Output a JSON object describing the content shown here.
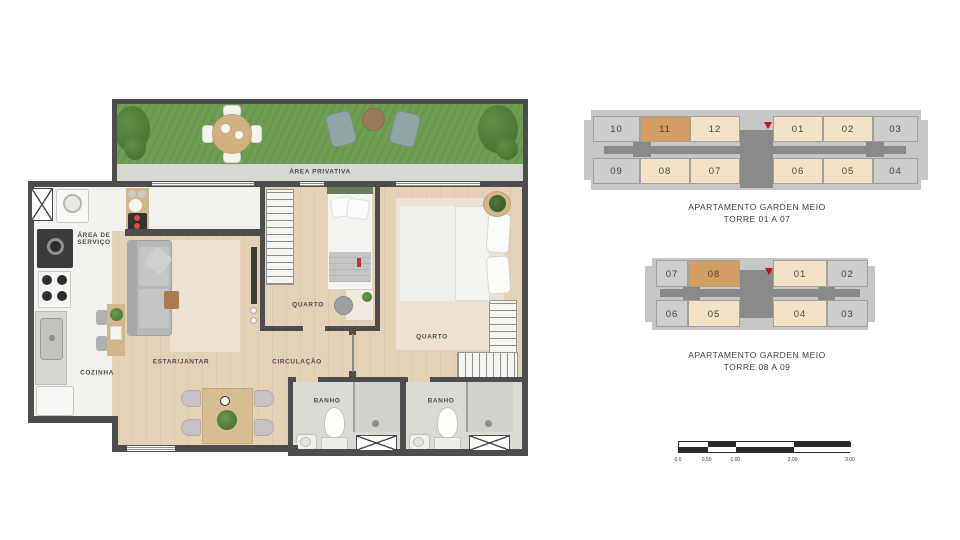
{
  "floorplan": {
    "garden_label": "ÁREA PRIVATIVA",
    "service_label": "ÁREA DE SERVIÇO",
    "kitchen_label": "COZINHA",
    "living_label": "ESTAR/JANTAR",
    "hall_label": "CIRCULAÇÃO",
    "bedroom1_label": "QUARTO",
    "bedroom2_label": "QUARTO",
    "bath1_label": "BANHO",
    "bath2_label": "BANHO"
  },
  "keyplans": [
    {
      "caption_line1": "APARTAMENTO GARDEN MEIO",
      "caption_line2": "TORRE 01 A 07",
      "top_units": [
        {
          "label": "10",
          "state": "other"
        },
        {
          "label": "11",
          "state": "selected"
        },
        {
          "label": "12",
          "state": "type"
        },
        {
          "label": "01",
          "state": "type"
        },
        {
          "label": "02",
          "state": "type"
        },
        {
          "label": "03",
          "state": "other"
        }
      ],
      "bottom_units": [
        {
          "label": "09",
          "state": "other"
        },
        {
          "label": "08",
          "state": "type"
        },
        {
          "label": "07",
          "state": "type"
        },
        {
          "label": "06",
          "state": "type"
        },
        {
          "label": "05",
          "state": "type"
        },
        {
          "label": "04",
          "state": "other"
        }
      ]
    },
    {
      "caption_line1": "APARTAMENTO GARDEN MEIO",
      "caption_line2": "TORRE 08 A 09",
      "top_units": [
        {
          "label": "07",
          "state": "other"
        },
        {
          "label": "08",
          "state": "selected"
        },
        {
          "label": "01",
          "state": "type"
        },
        {
          "label": "02",
          "state": "other"
        }
      ],
      "bottom_units": [
        {
          "label": "06",
          "state": "other"
        },
        {
          "label": "05",
          "state": "type"
        },
        {
          "label": "04",
          "state": "type"
        },
        {
          "label": "03",
          "state": "other"
        }
      ]
    }
  ],
  "scale_bar": {
    "labels": [
      "0.0",
      "0.50",
      "1.00",
      "2.00",
      "3.00"
    ]
  },
  "colors": {
    "unit_selected": "#d29e62",
    "unit_type": "#f3e2c4",
    "unit_other": "#cdcdcd",
    "core": "#8a8a8a",
    "marker": "#b3191e",
    "wall": "#4d4d4d"
  }
}
